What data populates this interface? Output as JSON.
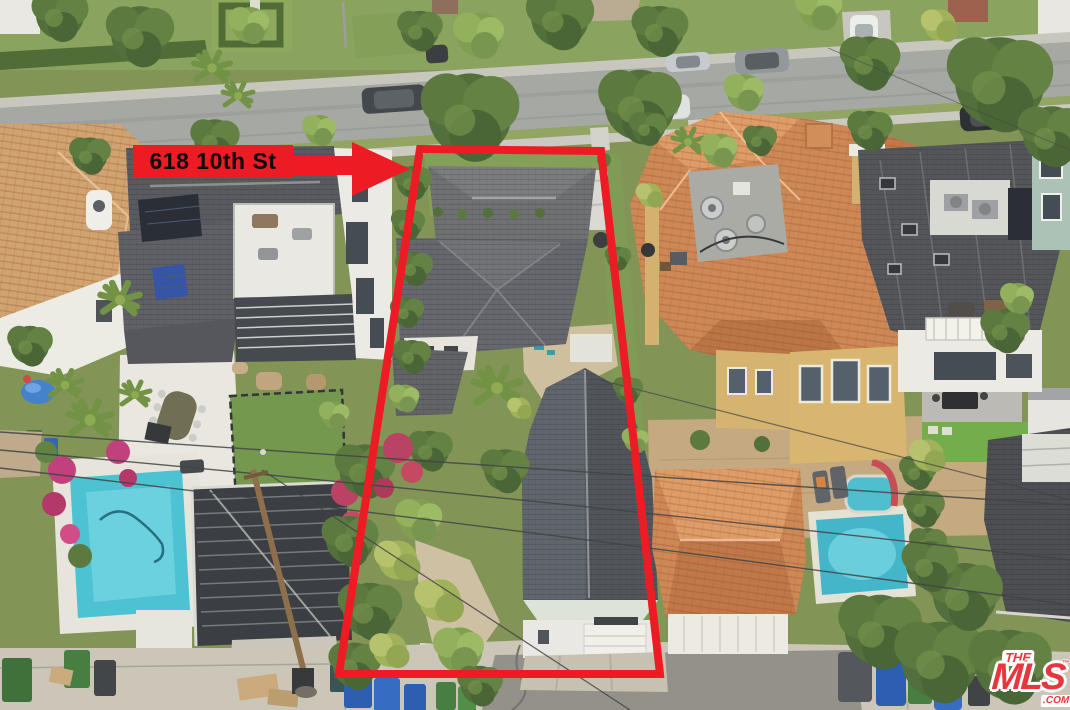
{
  "overlay": {
    "address_label": "618 10th St",
    "label_bg_color": "#ED1C24",
    "label_text_color": "#0b0b0b",
    "boundary_color": "#ED1C24"
  },
  "watermark": {
    "line1": "THE",
    "line2": "MLS",
    "trademark": "™",
    "suffix": ".COM",
    "brand_color": "#e8363c"
  },
  "scene": {
    "palette": {
      "road": "#a2a5a0",
      "sidewalk": "#c9c8bf",
      "alley_concrete": "#c9c4b6",
      "grass": "#7d9150",
      "tree_dark": "#4c6a33",
      "tree_light": "#8fae56",
      "subject_roof_gray": "#616268",
      "rear_roof_charcoal": "#4b4f55",
      "terracotta_roof": "#cd8450",
      "spanish_roof_faded": "#cfa06b",
      "modern_roof_dark": "#54555a",
      "pool_water": "#49c2d4",
      "white_walls": "#eceae4",
      "yellow_stucco": "#d8b36a",
      "bougainvillea": "#c03a78"
    }
  }
}
